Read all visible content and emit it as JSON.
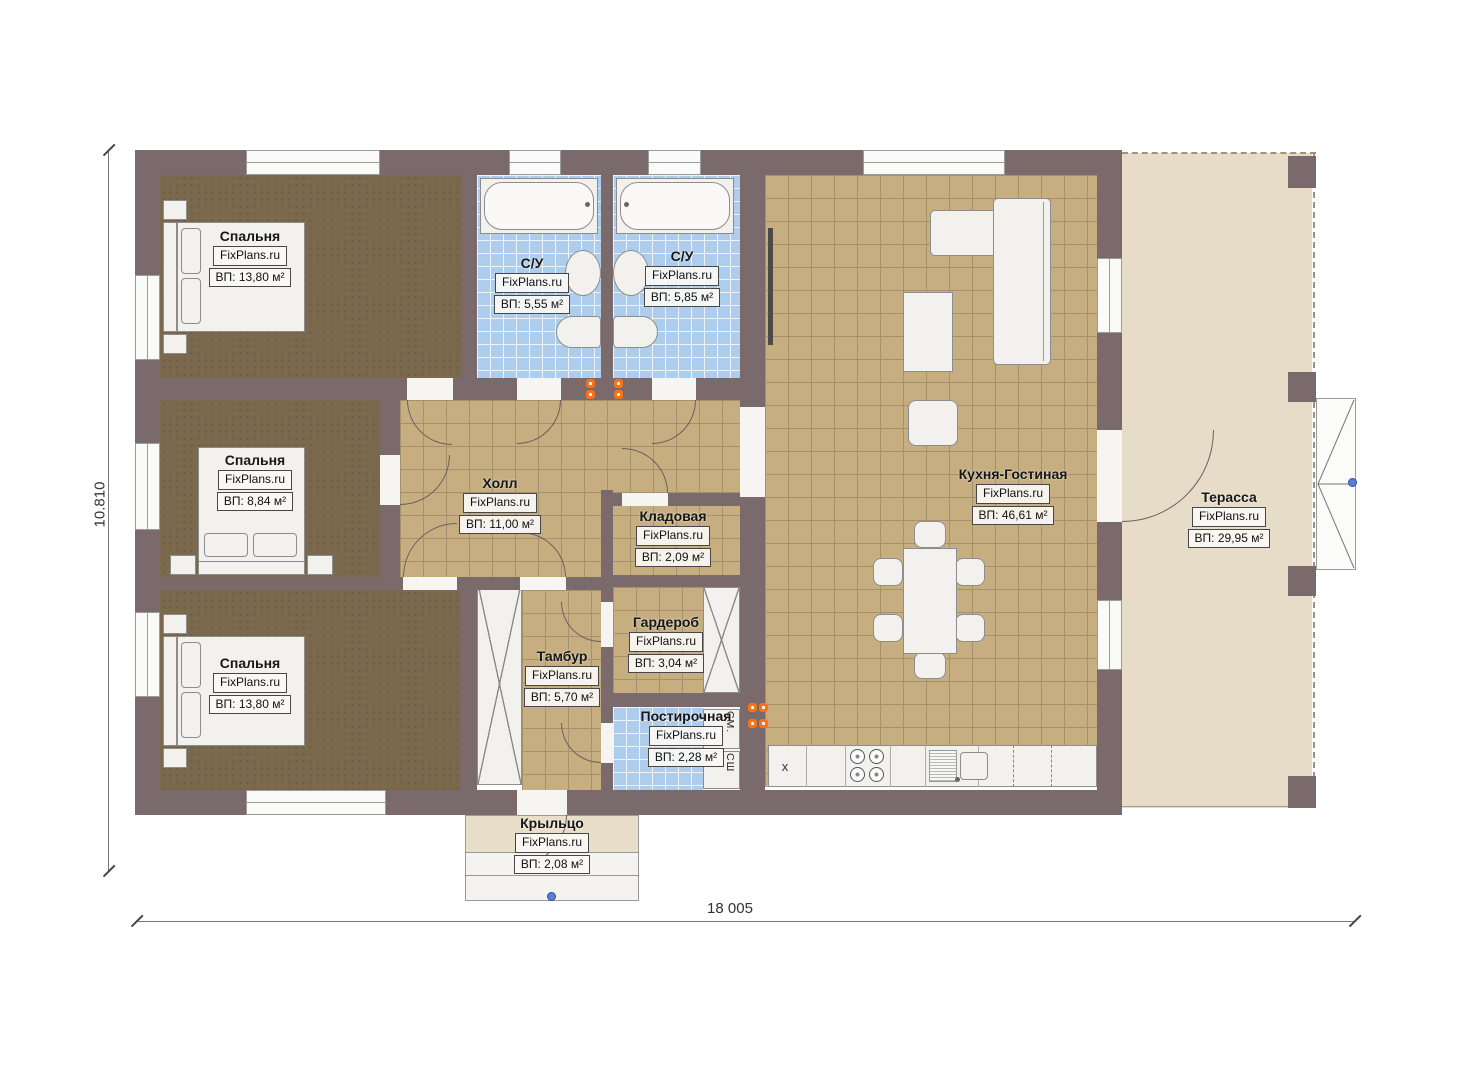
{
  "watermark": "FixPlans.ru",
  "dimensions": {
    "height_label": "10.810",
    "width_label": "18 005"
  },
  "rooms": {
    "bedroom1": {
      "name": "Спальня",
      "area": "ВП: 13,80 м²"
    },
    "bathroom1": {
      "name": "С/У",
      "area": "ВП: 5,55 м²"
    },
    "bathroom2": {
      "name": "С/У",
      "area": "ВП: 5,85 м²"
    },
    "kitchen_living": {
      "name": "Кухня-Гостиная",
      "area": "ВП: 46,61 м²"
    },
    "hall": {
      "name": "Холл",
      "area": "ВП: 11,00 м²"
    },
    "bedroom2": {
      "name": "Спальня",
      "area": "ВП: 8,84 м²"
    },
    "storage": {
      "name": "Кладовая",
      "area": "ВП: 2,09 м²"
    },
    "wardrobe": {
      "name": "Гардероб",
      "area": "ВП: 3,04 м²"
    },
    "bedroom3": {
      "name": "Спальня",
      "area": "ВП: 13,80 м²"
    },
    "tambour": {
      "name": "Тамбур",
      "area": "ВП: 5,70 м²"
    },
    "laundry": {
      "name": "Постирочная",
      "area": "ВП: 2,28 м²"
    },
    "terrace": {
      "name": "Терасса",
      "area": "ВП: 29,95 м²"
    },
    "porch": {
      "name": "Крыльцо",
      "area": "ВП: 2,08 м²"
    }
  },
  "appliance_labels": {
    "washer": "СМ.",
    "dryer": "СШ"
  },
  "kitchen_labels": {
    "fridge_slot": "x"
  },
  "colors": {
    "wall": "#7b6a6b",
    "bedroom_floor": "#7a694c",
    "tile_floor": "#c7ae80",
    "bath_floor": "#aecdec",
    "terrace_floor": "#e7dcc7",
    "radiator": "#f97316",
    "marker": "#5b7fd4"
  }
}
